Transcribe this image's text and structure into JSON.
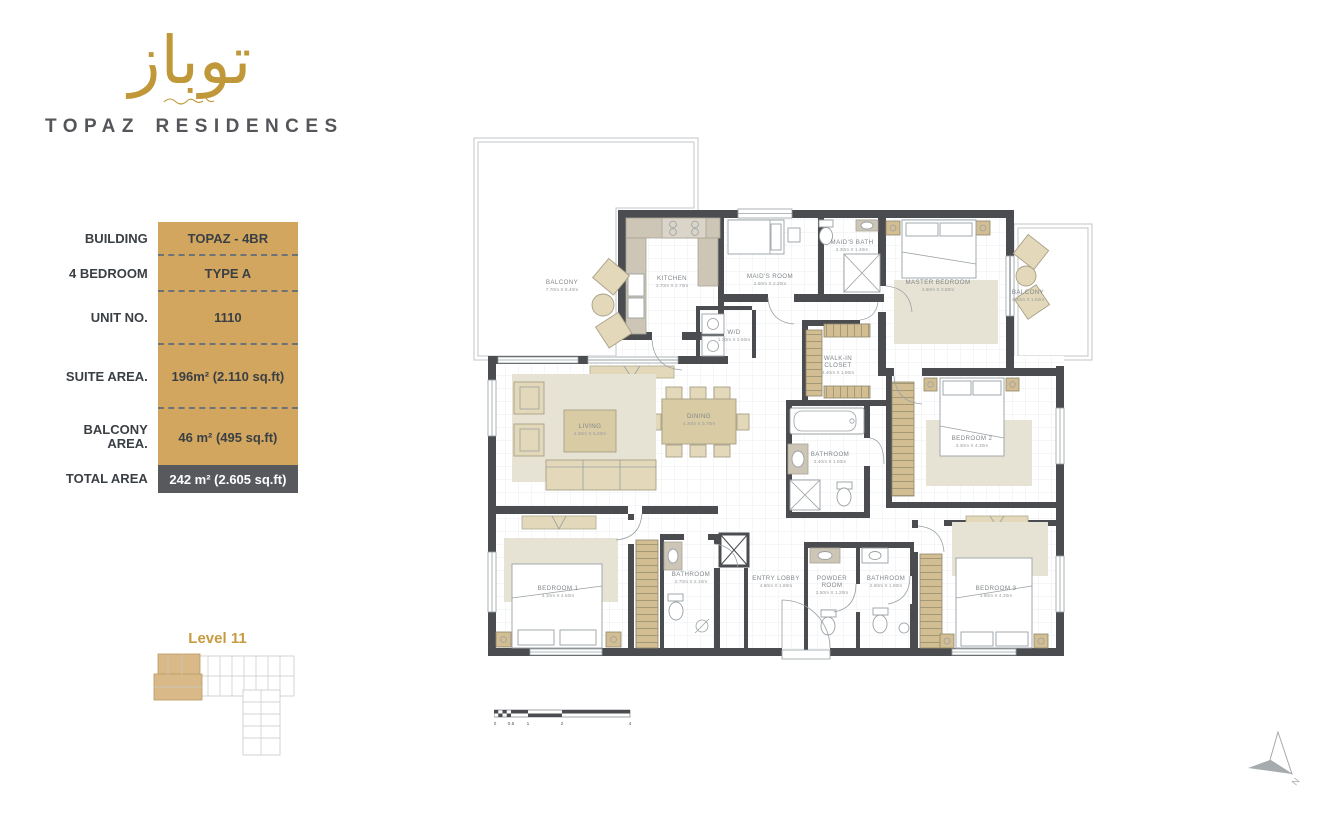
{
  "brand": {
    "logo_arabic": "توباز",
    "name": "TOPAZ RESIDENCES"
  },
  "info": {
    "rows": [
      {
        "label": "BUILDING",
        "value": "TOPAZ - 4BR"
      },
      {
        "label": "4 BEDROOM",
        "value": "TYPE A"
      },
      {
        "label": "UNIT NO.",
        "value": "1110"
      },
      {
        "label": "SUITE AREA.",
        "value": "196m² (2.110 sq.ft)"
      },
      {
        "label": "BALCONY AREA.",
        "value": "46 m² (495 sq.ft)"
      }
    ],
    "total": {
      "label": "TOTAL AREA",
      "value": "242 m² (2.605 sq.ft)"
    }
  },
  "level": {
    "label": "Level 11"
  },
  "rooms": {
    "balcony_left": {
      "name": "BALCONY",
      "dims": "7.70m X 8.40m"
    },
    "kitchen": {
      "name": "KITCHEN",
      "dims": "3.70m X 2.70m"
    },
    "maids_room": {
      "name": "MAID'S ROOM",
      "dims": "2.50m X 2.20m"
    },
    "maids_bath": {
      "name": "MAID'S BATH",
      "dims": "2.30m X 1.40m"
    },
    "wd": {
      "name": "W/D",
      "dims": "1.30m X 2.50m"
    },
    "walkin": {
      "name": "WALK-IN",
      "name2": "CLOSET",
      "dims": "2.40m X 1.90m"
    },
    "master": {
      "name": "MASTER BEDROOM",
      "dims": "4.60m X 3.80m"
    },
    "balcony_right": {
      "name": "BALCONY",
      "dims": "4.40m X 1.50m"
    },
    "bath_master": {
      "name": "BATHROOM",
      "dims": "3.40m X 1.90m"
    },
    "bedroom2": {
      "name": "BEDROOM 2",
      "dims": "3.30m X 4.30m"
    },
    "living": {
      "name": "LIVING",
      "dims": "4.30m X 5.20m"
    },
    "dining": {
      "name": "DINING",
      "dims": "4.30m X 3.70m"
    },
    "bedroom1": {
      "name": "BEDROOM 1",
      "dims": "4.10m X 4.50m"
    },
    "bath1": {
      "name": "BATHROOM",
      "dims": "2.70m X 2.10m"
    },
    "entry": {
      "name": "ENTRY LOBBY",
      "dims": "4.50m X 1.80m"
    },
    "powder": {
      "name": "POWDER",
      "name2": "ROOM",
      "dims": "2.50m X 1.20m"
    },
    "bath3": {
      "name": "BATHROOM",
      "dims": "2.50m X 1.80m"
    },
    "bedroom3": {
      "name": "BEDROOM 3",
      "dims": "3.80m X 4.30m"
    }
  },
  "scalebar": {
    "ticks": [
      "0",
      "0.5",
      "1",
      "2",
      "4"
    ]
  },
  "compass": {
    "label": "N"
  },
  "colors": {
    "gold": "#d2a65e",
    "slate": "#58595d",
    "wall": "#4b4c50",
    "logo_gold": "#c09739"
  }
}
